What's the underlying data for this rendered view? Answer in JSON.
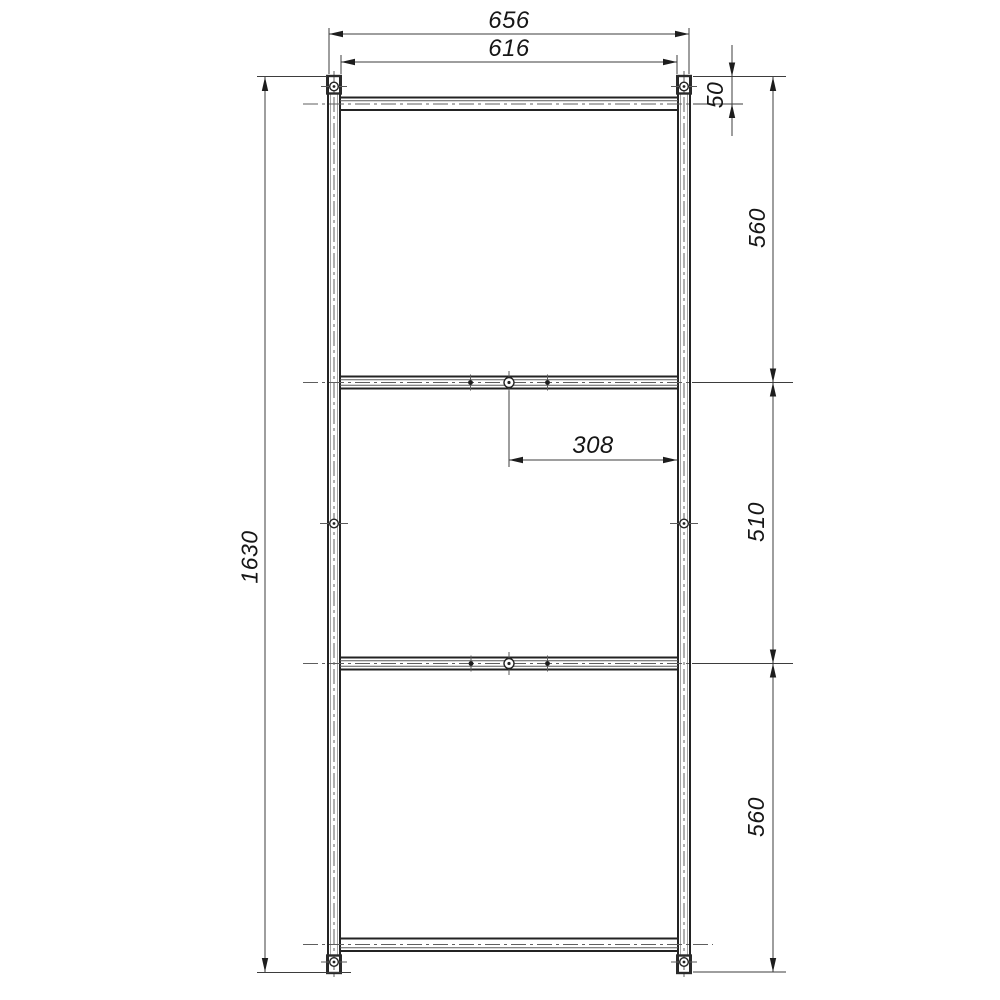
{
  "drawing": {
    "type": "technical-dimension-drawing",
    "subject": "frame side elevation with three shelf rails",
    "background_color": "#ffffff",
    "outline_color": "#232323",
    "dimension_line_color": "#3d3d3d",
    "dimensions": {
      "overall_width": "656",
      "inner_width": "616",
      "top_rail_drop": "50",
      "overall_height": "1630",
      "section_top": "560",
      "section_middle": "510",
      "section_bottom": "560",
      "rail_half_span": "308"
    }
  }
}
